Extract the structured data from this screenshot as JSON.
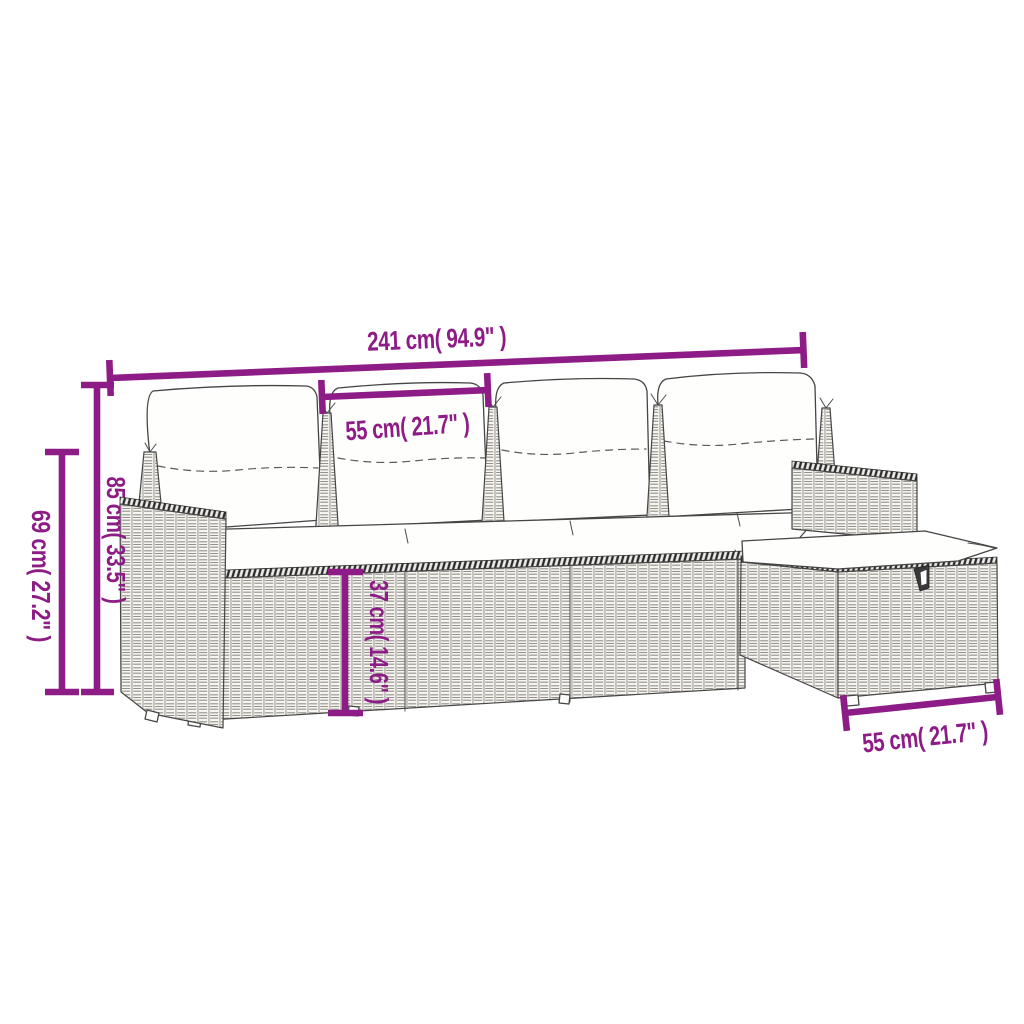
{
  "colors": {
    "background": "#ffffff",
    "dimension_accent": "#8E1C86",
    "line_art": "#3d3d3d",
    "cushion_fill": "#fefefd"
  },
  "illustration": {
    "type": "line-art-dimension-diagram",
    "subject": "rattan garden sofa set with back pillows, seat cushions and ottoman",
    "parts": [
      "back-pillows",
      "pillow-posts",
      "seat-cushions",
      "sofa-base",
      "left-armrest",
      "right-armrest",
      "ottoman",
      "ottoman-cushion",
      "ottoman-handle"
    ]
  },
  "dims": {
    "overall": {
      "label": "241 cm( 94.9\" )",
      "orientation": "horizontal"
    },
    "seat": {
      "label": "55 cm( 21.7\" )",
      "orientation": "horizontal"
    },
    "height69": {
      "label": "69 cm( 27.2\" )",
      "orientation": "vertical"
    },
    "height85": {
      "label": "85 cm( 33.5\" )",
      "orientation": "vertical"
    },
    "height37": {
      "label": "37 cm( 14.6\" )",
      "orientation": "vertical"
    },
    "ottoman": {
      "label": "55 cm( 21.7\" )",
      "orientation": "horizontal"
    }
  }
}
